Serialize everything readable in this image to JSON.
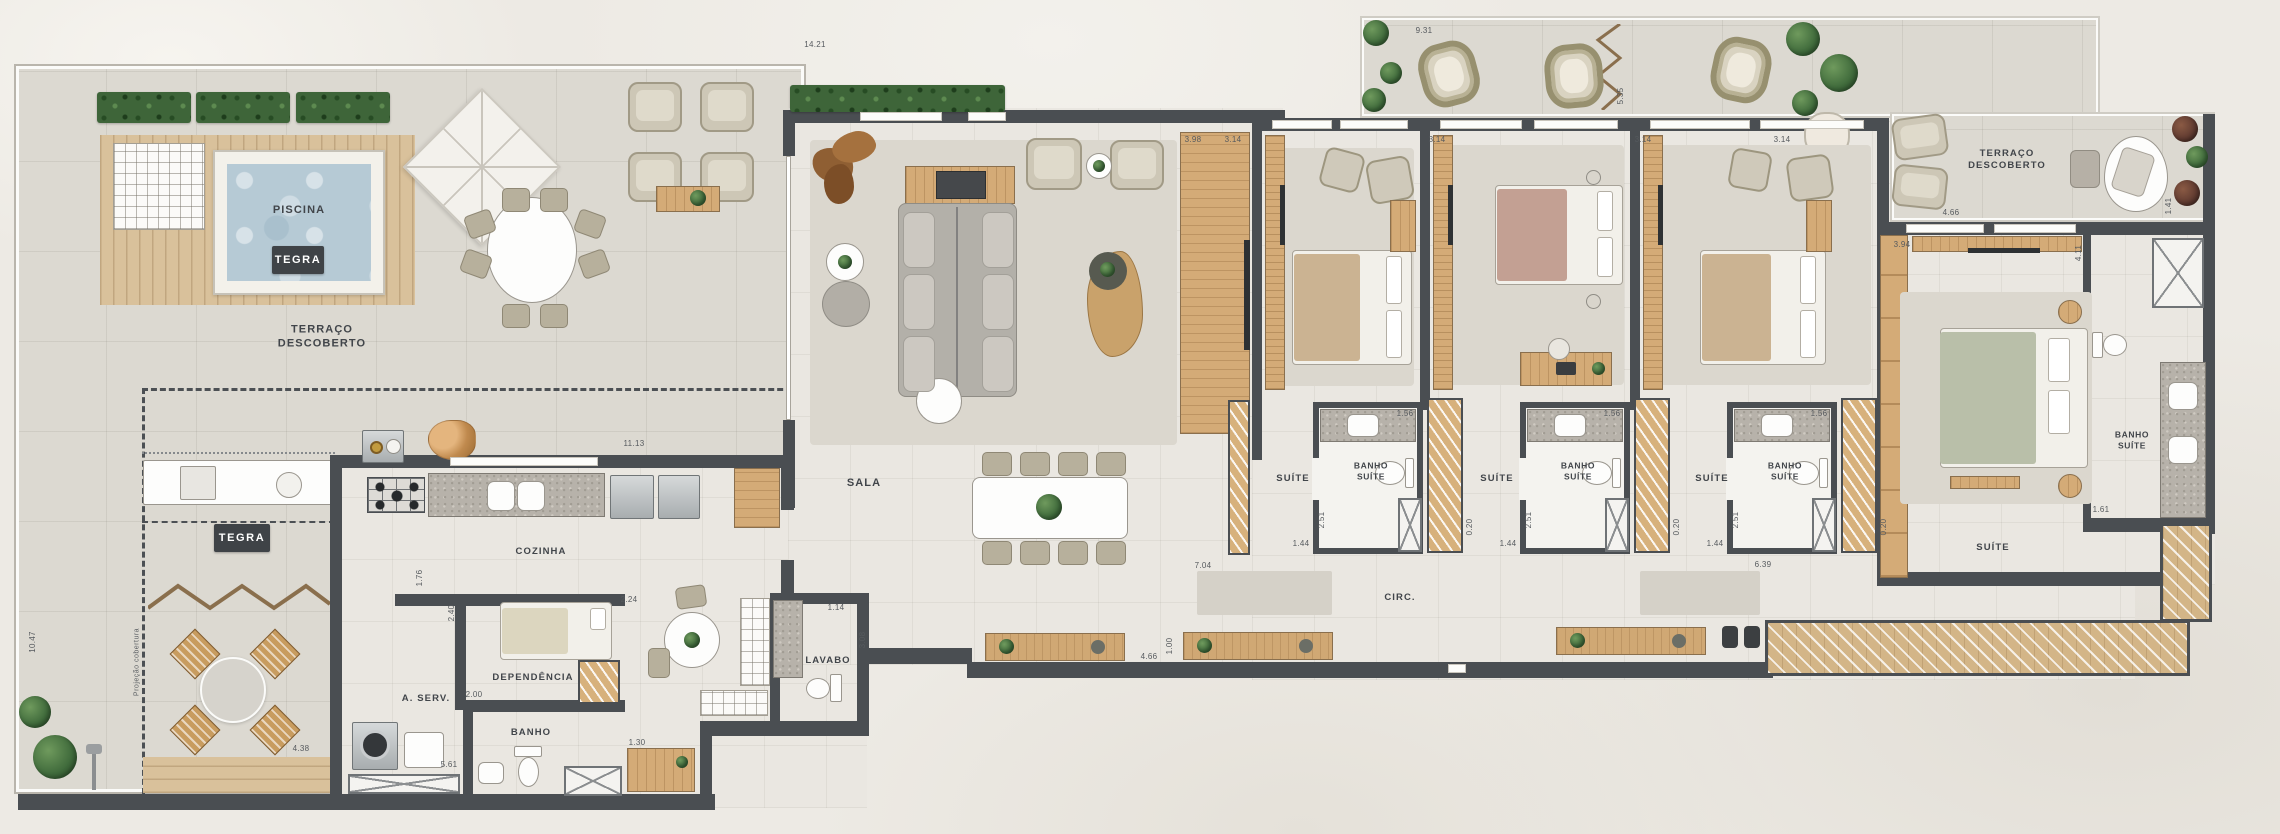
{
  "plan": {
    "brand": {
      "name": "TEGRA"
    },
    "labels": {
      "piscina": "PISCINA",
      "terraco_left": "TERRAÇO DESCOBERTO",
      "terraco_right": "TERRAÇO DESCOBERTO",
      "sala": "SALA",
      "cozinha": "COZINHA",
      "dependencia": "DEPENDÊNCIA",
      "aserv": "A. SERV.",
      "banho": "BANHO",
      "lavabo": "LAVABO",
      "suite": "SUÍTE",
      "banho_suite": "BANHO SUÍTE",
      "circ": "CIRC.",
      "projecao": "Projeção cobertura"
    },
    "dimensions": [
      "10.47",
      "4.38",
      "14.21",
      "9.31",
      "5.35",
      "11.13",
      "1.76",
      "2.40",
      "2.00",
      "2.24",
      "1.30",
      "1.14",
      "3.08",
      "5.61",
      "3.98",
      "3.14",
      "3.14",
      "3.14",
      "3.14",
      "3.94",
      "4.66",
      "1.41",
      "4.11",
      "1.61",
      "1.56",
      "1.56",
      "1.56",
      "2.51",
      "2.51",
      "2.51",
      "1.44",
      "1.44",
      "1.44",
      "0.20",
      "0.20",
      "0.20",
      "7.04",
      "6.39",
      "4.66",
      "1.00"
    ],
    "colors": {
      "wall": "#4a4e52",
      "wood": "#d4ab77",
      "water": "#b6cad5",
      "hedge": "#3e6539",
      "terrace_floor": "#dcd9d1",
      "indoor_floor": "#eae7e1",
      "logo_plate": "#3f4347"
    }
  }
}
